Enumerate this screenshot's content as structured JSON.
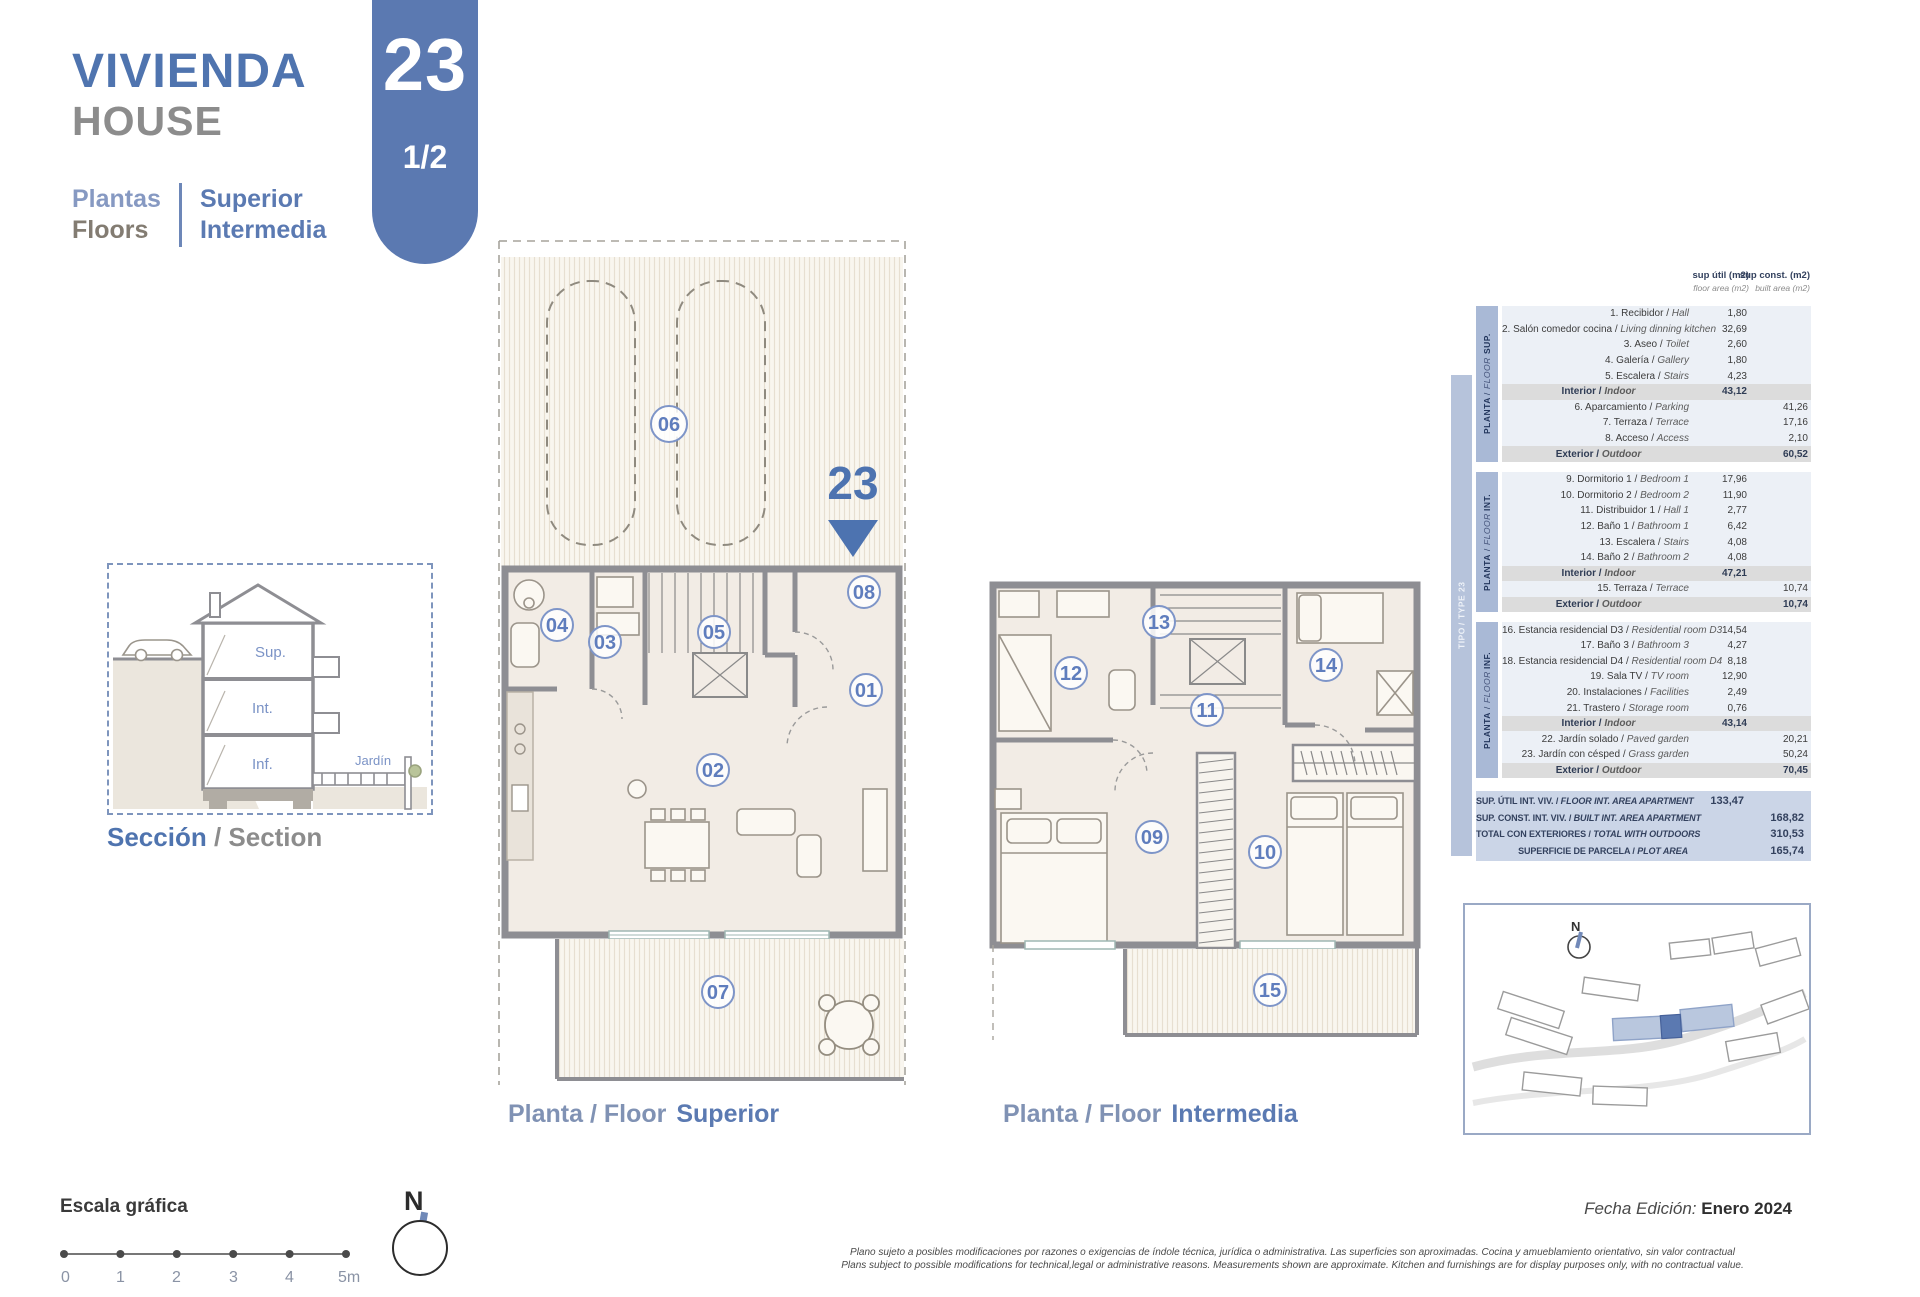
{
  "header": {
    "title_es": "VIVIENDA",
    "title_en": "HOUSE",
    "badge_number": "23",
    "badge_page": "1/2",
    "floors_label_es": "Plantas",
    "floors_label_en": "Floors",
    "floors_value_1": "Superior",
    "floors_value_2": "Intermedia"
  },
  "section_view": {
    "caption_es": "Sección",
    "caption_sep": " / ",
    "caption_en": "Section",
    "labels": {
      "sup": "Sup.",
      "int": "Int.",
      "inf": "Inf.",
      "garden": "Jardín"
    }
  },
  "plans": {
    "superior": {
      "caption_prefix": "Planta / Floor",
      "caption_name": "Superior",
      "unit_marker": "23",
      "room_labels": [
        "06",
        "04",
        "03",
        "05",
        "08",
        "01",
        "02",
        "07"
      ]
    },
    "intermedia": {
      "caption_prefix": "Planta / Floor",
      "caption_name": "Intermedia",
      "room_labels": [
        "12",
        "13",
        "14",
        "11",
        "09",
        "10",
        "15"
      ]
    }
  },
  "area_table": {
    "col_headers": {
      "util_l1": "sup útil (m2)",
      "util_l2": "floor area (m2)",
      "const_l1": "sup const. (m2)",
      "const_l2": "built area (m2)"
    },
    "type_label": {
      "es": "TIPO",
      "en": "TYPE",
      "num": "23"
    },
    "sections": [
      {
        "floor": {
          "es": "PLANTA",
          "en": "FLOOR",
          "tag": "SUP."
        },
        "rows": [
          {
            "es": "1. Recibidor",
            "en": "Hall",
            "util": "1,80",
            "const": ""
          },
          {
            "es": "2. Salón comedor cocina",
            "en": "Living dinning kitchen",
            "util": "32,69",
            "const": ""
          },
          {
            "es": "3. Aseo",
            "en": "Toilet",
            "util": "2,60",
            "const": ""
          },
          {
            "es": "4. Galería",
            "en": "Gallery",
            "util": "1,80",
            "const": ""
          },
          {
            "es": "5. Escalera",
            "en": "Stairs",
            "util": "4,23",
            "const": ""
          },
          {
            "es": "Interior",
            "en": "Indoor",
            "util": "43,12",
            "const": "",
            "subtotal": true
          },
          {
            "es": "6. Aparcamiento",
            "en": "Parking",
            "util": "",
            "const": "41,26"
          },
          {
            "es": "7. Terraza",
            "en": "Terrace",
            "util": "",
            "const": "17,16"
          },
          {
            "es": "8. Acceso",
            "en": "Access",
            "util": "",
            "const": "2,10"
          },
          {
            "es": "Exterior",
            "en": "Outdoor",
            "util": "",
            "const": "60,52",
            "subtotal": true
          }
        ]
      },
      {
        "floor": {
          "es": "PLANTA",
          "en": "FLOOR",
          "tag": "INT."
        },
        "rows": [
          {
            "es": "9. Dormitorio 1",
            "en": "Bedroom 1",
            "util": "17,96",
            "const": ""
          },
          {
            "es": "10. Dormitorio 2",
            "en": "Bedroom 2",
            "util": "11,90",
            "const": ""
          },
          {
            "es": "11. Distribuidor 1",
            "en": "Hall 1",
            "util": "2,77",
            "const": ""
          },
          {
            "es": "12. Baño 1",
            "en": "Bathroom 1",
            "util": "6,42",
            "const": ""
          },
          {
            "es": "13. Escalera",
            "en": "Stairs",
            "util": "4,08",
            "const": ""
          },
          {
            "es": "14. Baño 2",
            "en": "Bathroom 2",
            "util": "4,08",
            "const": ""
          },
          {
            "es": "Interior",
            "en": "Indoor",
            "util": "47,21",
            "const": "",
            "subtotal": true
          },
          {
            "es": "15. Terraza",
            "en": "Terrace",
            "util": "",
            "const": "10,74"
          },
          {
            "es": "Exterior",
            "en": "Outdoor",
            "util": "",
            "const": "10,74",
            "subtotal": true
          }
        ]
      },
      {
        "floor": {
          "es": "PLANTA",
          "en": "FLOOR",
          "tag": "INF."
        },
        "rows": [
          {
            "es": "16. Estancia residencial D3",
            "en": "Residential room D3",
            "util": "14,54",
            "const": ""
          },
          {
            "es": "17. Baño 3",
            "en": "Bathroom 3",
            "util": "4,27",
            "const": ""
          },
          {
            "es": "18. Estancia residencial D4",
            "en": "Residential room D4",
            "util": "8,18",
            "const": ""
          },
          {
            "es": "19. Sala TV",
            "en": "TV room",
            "util": "12,90",
            "const": ""
          },
          {
            "es": "20. Instalaciones",
            "en": "Facilities",
            "util": "2,49",
            "const": ""
          },
          {
            "es": "21. Trastero",
            "en": "Storage room",
            "util": "0,76",
            "const": ""
          },
          {
            "es": "Interior",
            "en": "Indoor",
            "util": "43,14",
            "const": "",
            "subtotal": true
          },
          {
            "es": "22. Jardín solado",
            "en": "Paved garden",
            "util": "",
            "const": "20,21"
          },
          {
            "es": "23. Jardín con césped",
            "en": "Grass garden",
            "util": "",
            "const": "50,24"
          },
          {
            "es": "Exterior",
            "en": "Outdoor",
            "util": "",
            "const": "70,45",
            "subtotal": true
          }
        ]
      }
    ],
    "summary": [
      {
        "es": "SUP. ÚTIL INT. VIV.",
        "en": "FLOOR INT. AREA APARTMENT",
        "util": "133,47",
        "const": ""
      },
      {
        "es": "SUP. CONST. INT. VIV.",
        "en": "BUILT INT. AREA APARTMENT",
        "util": "",
        "const": "168,82"
      },
      {
        "es": "TOTAL CON EXTERIORES",
        "en": "TOTAL WITH OUTDOORS",
        "util": "",
        "const": "310,53"
      },
      {
        "es": "SUPERFICIE DE PARCELA",
        "en": "PLOT AREA",
        "util": "",
        "const": "165,74"
      }
    ]
  },
  "site_plan": {
    "north_label": "N"
  },
  "scale_bar": {
    "title": "Escala gráfica",
    "ticks": [
      "0",
      "1",
      "2",
      "3",
      "4",
      "5m"
    ]
  },
  "compass": {
    "north_label": "N"
  },
  "footer": {
    "edition_label": "Fecha Edición:",
    "edition_value": "Enero 2024",
    "disclaimer_es": "Plano sujeto a posibles modificaciones por razones o exigencias de índole técnica, jurídica o administrativa. Las superficies son aproximadas. Cocina y amueblamiento orientativo, sin valor contractual",
    "disclaimer_en": "Plans subject to possible modifications for technical,legal or administrative reasons. Measurements shown are approximate. Kitchen and furnishings are for display purposes only, with no contractual value."
  },
  "colors": {
    "brand_blue": "#5b79b1",
    "title_blue": "#4f74af",
    "gray": "#8c8c8c",
    "wall_gray": "#8e8e93",
    "room_fill": "#f2ece5",
    "badge_blue": "#7e95c8"
  }
}
